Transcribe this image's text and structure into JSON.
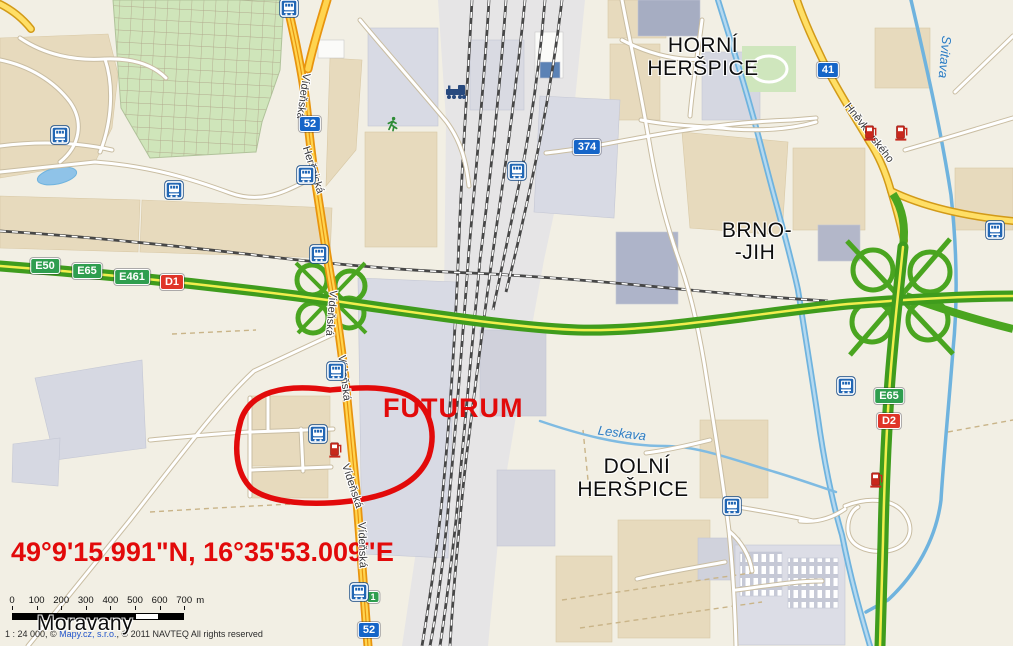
{
  "map": {
    "background_color": "#f2efe4",
    "annotations": {
      "landmark_text": "FUTURUM",
      "coordinates_text": "49°9'15.991\"N, 16°35'53.009\"E",
      "color": "#e20a0a"
    },
    "place_labels": [
      {
        "text": "HORNÍ",
        "x": 703,
        "y": 46
      },
      {
        "text": "HERŠPICE",
        "x": 703,
        "y": 69
      },
      {
        "text": "BRNO-",
        "x": 757,
        "y": 231
      },
      {
        "text": "-JIH",
        "x": 755,
        "y": 253
      },
      {
        "text": "DOLNÍ",
        "x": 637,
        "y": 467
      },
      {
        "text": "HERŠPICE",
        "x": 633,
        "y": 490
      },
      {
        "text": "Moravany",
        "x": 85,
        "y": 624
      }
    ],
    "street_labels": [
      {
        "text": "Vídeňská",
        "x": 303,
        "y": 96,
        "rot": 98
      },
      {
        "text": "Heršpická",
        "x": 313,
        "y": 170,
        "rot": 72
      },
      {
        "text": "Vídeňská",
        "x": 331,
        "y": 313,
        "rot": 95
      },
      {
        "text": "Vídeňská",
        "x": 344,
        "y": 378,
        "rot": 83
      },
      {
        "text": "Vídeňská",
        "x": 352,
        "y": 486,
        "rot": 72
      },
      {
        "text": "Vídeňská",
        "x": 362,
        "y": 545,
        "rot": 88
      },
      {
        "text": "Hněvkovského",
        "x": 869,
        "y": 133,
        "rot": 52
      }
    ],
    "water_labels": [
      {
        "text": "Svitava",
        "x": 945,
        "y": 57,
        "rot": 95
      },
      {
        "text": "Leskava",
        "x": 622,
        "y": 433,
        "rot": 7
      }
    ],
    "shields": [
      {
        "text": "52",
        "type": "blue",
        "x": 310,
        "y": 124
      },
      {
        "text": "374",
        "type": "blue",
        "x": 587,
        "y": 147
      },
      {
        "text": "41",
        "type": "blue",
        "x": 828,
        "y": 70
      },
      {
        "text": "52",
        "type": "blue",
        "x": 369,
        "y": 630
      },
      {
        "text": "E50",
        "type": "green",
        "x": 45,
        "y": 266
      },
      {
        "text": "E65",
        "type": "green",
        "x": 87,
        "y": 271
      },
      {
        "text": "E461",
        "type": "green",
        "x": 132,
        "y": 277
      },
      {
        "text": "D1",
        "type": "red",
        "x": 172,
        "y": 282
      },
      {
        "text": "E65",
        "type": "green",
        "x": 889,
        "y": 396
      },
      {
        "text": "D2",
        "type": "red",
        "x": 889,
        "y": 421
      },
      {
        "text": "1",
        "type": "green",
        "x": 373,
        "y": 597,
        "small": true
      }
    ],
    "icons": [
      {
        "type": "tram",
        "x": 60,
        "y": 135
      },
      {
        "type": "tram",
        "x": 174,
        "y": 190
      },
      {
        "type": "tram",
        "x": 289,
        "y": 8
      },
      {
        "type": "tram",
        "x": 306,
        "y": 175
      },
      {
        "type": "tram",
        "x": 319,
        "y": 254
      },
      {
        "type": "tram",
        "x": 336,
        "y": 371
      },
      {
        "type": "tram",
        "x": 517,
        "y": 171
      },
      {
        "type": "tram",
        "x": 318,
        "y": 434
      },
      {
        "type": "tram",
        "x": 846,
        "y": 386
      },
      {
        "type": "tram",
        "x": 732,
        "y": 506
      },
      {
        "type": "tram",
        "x": 359,
        "y": 592
      },
      {
        "type": "tram",
        "x": 995,
        "y": 230
      },
      {
        "type": "train",
        "x": 456,
        "y": 92
      },
      {
        "type": "fuel",
        "x": 336,
        "y": 450
      },
      {
        "type": "fuel",
        "x": 871,
        "y": 133
      },
      {
        "type": "fuel",
        "x": 902,
        "y": 133
      },
      {
        "type": "fuel",
        "x": 877,
        "y": 480
      },
      {
        "type": "runner",
        "x": 392,
        "y": 124
      }
    ],
    "scale_bar": {
      "ticks": [
        "0",
        "100",
        "200",
        "300",
        "400",
        "500",
        "600",
        "700"
      ],
      "unit": "m"
    },
    "attribution": {
      "prefix": "1 : 24 000, © ",
      "link_text": "Mapy.cz, s.r.o.",
      "suffix": ", © 2011 NAVTEQ All rights reserved"
    }
  }
}
